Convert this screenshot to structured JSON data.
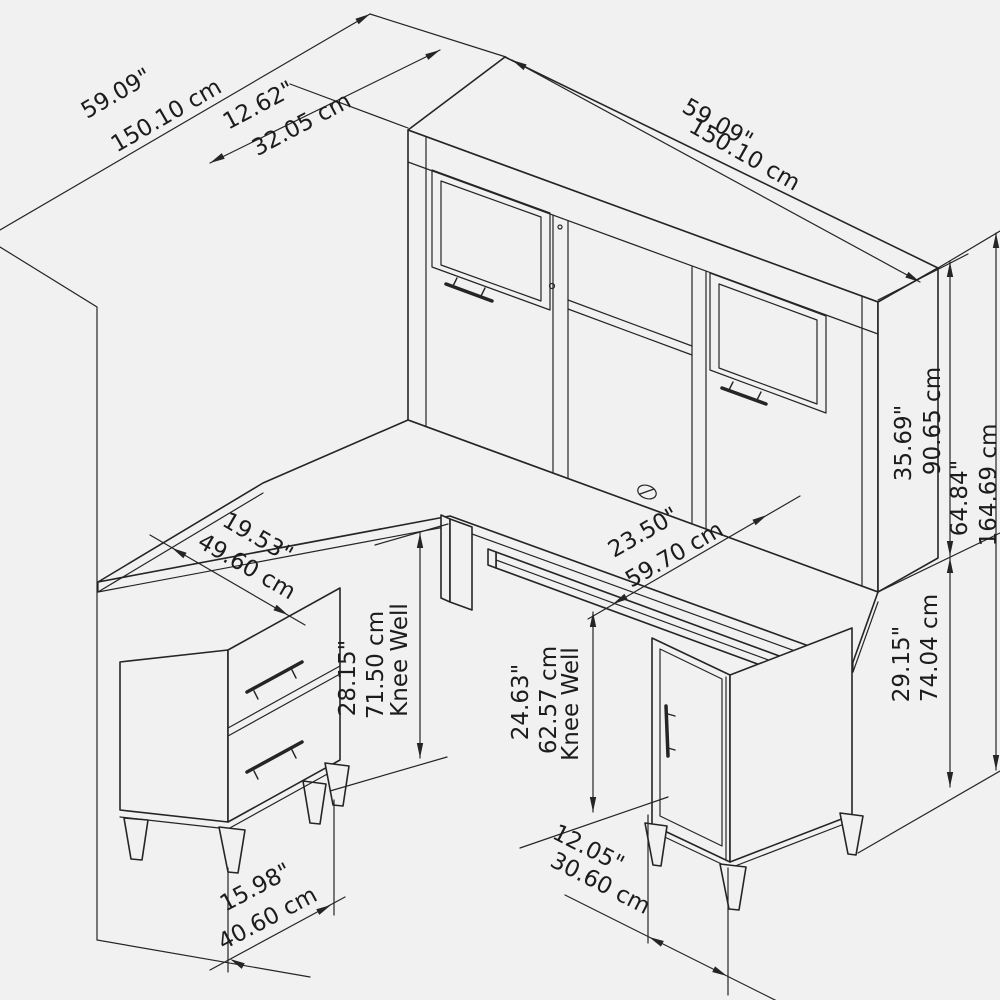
{
  "title": "L-shaped desk with hutch dimension diagram",
  "colors": {
    "background": "#f1f1f1",
    "line": "#252525"
  },
  "dims": {
    "return_length": {
      "in": "59.09\"",
      "cm": "150.10 cm"
    },
    "hutch_depth": {
      "in": "12.62\"",
      "cm": "32.05 cm"
    },
    "hutch_width": {
      "in": "59.09\"",
      "cm": "150.10 cm"
    },
    "hutch_height": {
      "in": "35.69\"",
      "cm": "90.65 cm"
    },
    "total_height": {
      "in": "64.84\"",
      "cm": "164.69 cm"
    },
    "desk_height": {
      "in": "29.15\"",
      "cm": "74.04 cm"
    },
    "desk_depth": {
      "in": "23.50\"",
      "cm": "59.70 cm"
    },
    "return_depth": {
      "in": "19.53\"",
      "cm": "49.60 cm"
    },
    "left_knee_well": {
      "in": "28.15\"",
      "cm": "71.50 cm",
      "note": "Knee Well"
    },
    "center_knee_well": {
      "in": "24.63\"",
      "cm": "62.57 cm",
      "note": "Knee Well"
    },
    "left_foot_depth": {
      "in": "15.98\"",
      "cm": "40.60 cm"
    },
    "right_foot_depth": {
      "in": "12.05\"",
      "cm": "30.60 cm"
    }
  }
}
